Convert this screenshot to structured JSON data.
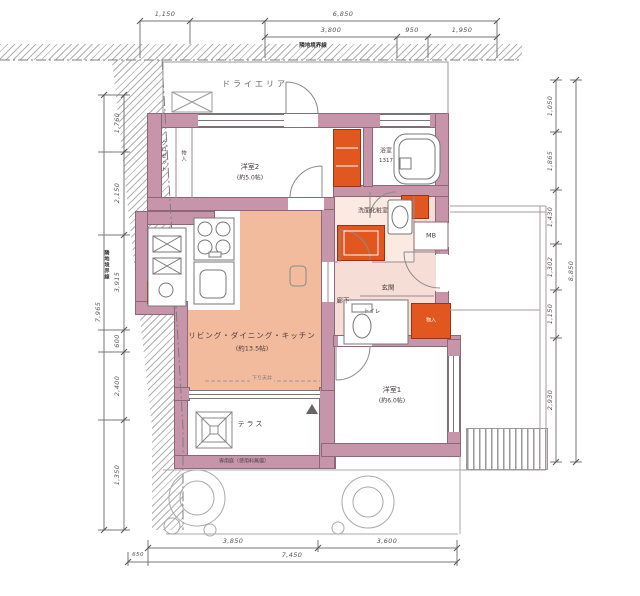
{
  "rooms": {
    "dry_area": "ドライエリア",
    "bedroom2": "洋室2",
    "bedroom2_size": "(約5.0帖)",
    "closet_left": "クロゼット",
    "closet_strip": "物入",
    "bathroom": "浴室",
    "bathroom_size": "1317",
    "washroom": "洗面化粧室",
    "hallway": "廊下",
    "entrance": "玄関",
    "toilet": "トイレ",
    "storage_box": "物入",
    "meter_box": "MB",
    "ldk": "リビング・ダイニング・キッチン",
    "ldk_size": "(約13.5帖)",
    "bedroom1": "洋室1",
    "bedroom1_size": "(約6.0帖)",
    "terrace": "テラス"
  },
  "notes": {
    "boundary_top": "隣地境界線",
    "boundary_left": "隣地境界線",
    "ceiling_note": "下り天井",
    "terrace_note": "専用庭（使用料無償）"
  },
  "dimensions": {
    "top_row1": [
      "1,150",
      "6,850"
    ],
    "top_row2": [
      "3,800",
      "950",
      "1,950"
    ],
    "bottom_row1": [
      "3,850",
      "3,600"
    ],
    "bottom_left": "650",
    "bottom_total": "7,450",
    "left_chain": [
      "1,760",
      "2,150",
      "3,915",
      "600",
      "2,400",
      "1,350"
    ],
    "left_total": "7,965",
    "right_chain": [
      "1,050",
      "1,865",
      "1,430",
      "1,302",
      "1,150",
      "2,930"
    ],
    "right_total": "8,850"
  },
  "colors": {
    "wall": "#c795a9",
    "ldk_fill": "#f3bb9d",
    "hall_fill": "#f6ded6",
    "accent_orange": "#e2571f"
  }
}
